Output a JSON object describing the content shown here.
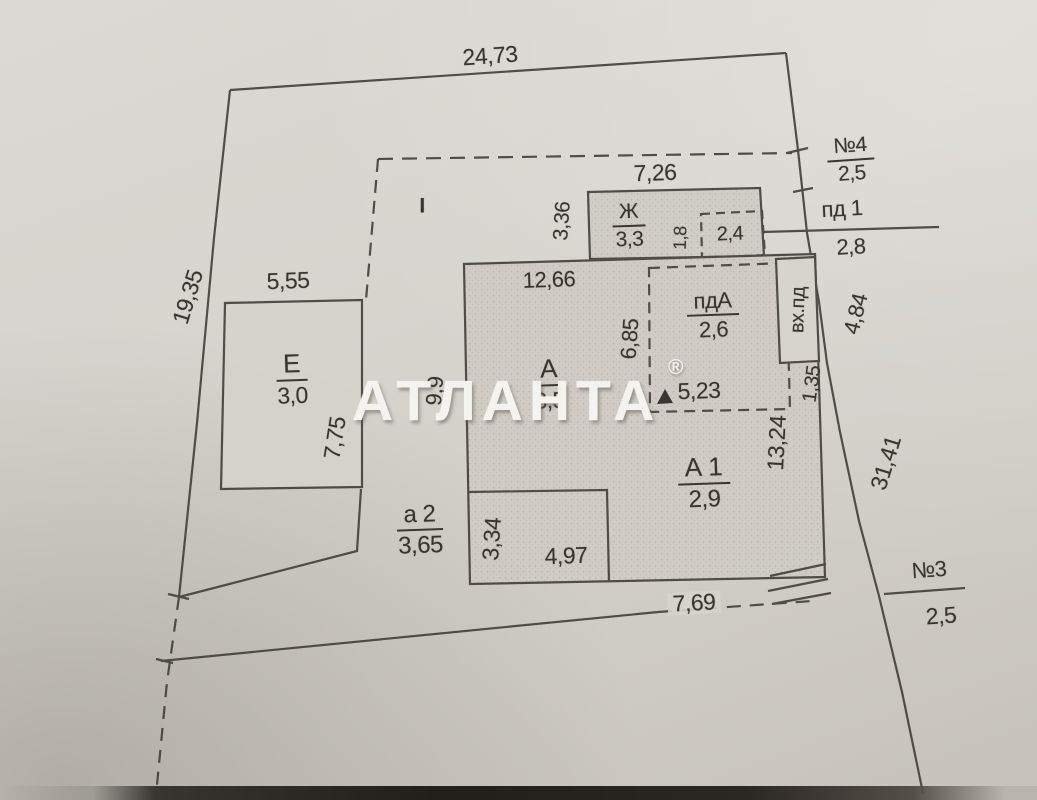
{
  "plan": {
    "watermark": {
      "text": "АТЛАНТА",
      "reg": "®"
    },
    "section_label": "I",
    "outer": {
      "top": "24,73",
      "left": "19,35",
      "right_upper": "4,84",
      "right_lower": "31,41",
      "bottom": "7,69"
    },
    "markers": {
      "n4": {
        "name": "№4",
        "value": "2,5"
      },
      "pd1": {
        "name": "пд 1",
        "value": "2,8"
      },
      "n3": {
        "name": "№3",
        "value": "2,5"
      }
    },
    "buildings": {
      "zh": {
        "label": "Ж",
        "area": "3,3",
        "width": "7,26",
        "side": "3,36",
        "inner_depth": "1,8",
        "inner_width": "2,4"
      },
      "e": {
        "label": "Е",
        "area": "3,0",
        "width": "5,55",
        "height": "7,75"
      },
      "a": {
        "label": "А",
        "area": "3,5",
        "width": "12,66",
        "side": "9,9"
      },
      "pda": {
        "label": "пдА",
        "area": "2,6",
        "side": "6,85",
        "width": "5,23",
        "entry_label": "вх.пд",
        "entry_side": "1,35"
      },
      "a1": {
        "label": "А 1",
        "area": "2,9",
        "side": "13,24"
      },
      "a2": {
        "label": "а 2",
        "area": "3,65",
        "inner_side": "3,34",
        "inner_width": "4,97"
      }
    }
  }
}
